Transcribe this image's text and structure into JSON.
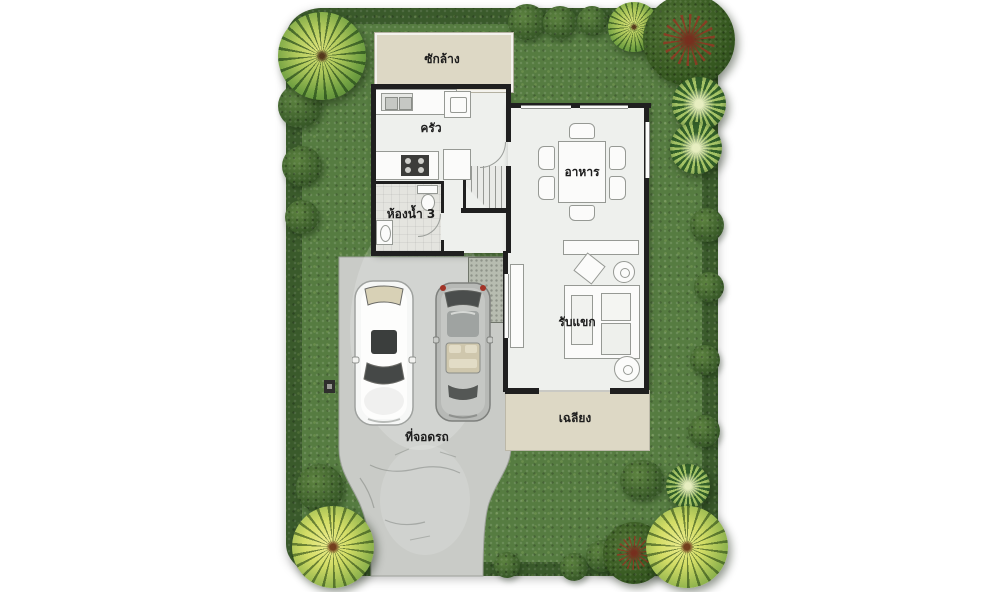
{
  "scene": {
    "type": "house floor plan with garden, driveway and two parked cars"
  },
  "rooms": {
    "laundry": {
      "label": "ซักล้าง"
    },
    "kitchen": {
      "label": "ครัว"
    },
    "bathroom3": {
      "label": "ห้องน้ำ 3"
    },
    "dining": {
      "label": "อาหาร"
    },
    "living": {
      "label": "รับแขก"
    },
    "porch": {
      "label": "เฉลียง"
    },
    "parking": {
      "label": "ที่จอดรถ"
    }
  },
  "colors": {
    "grass": "#567c41",
    "hedge": "#3a5a2b",
    "driveway": "#c9cbc7",
    "floor": "#eef0ed",
    "terrace_beige": "#ddd8c5",
    "wall": "#1f1f1f",
    "car_white": "#f6f7f6",
    "car_silver": "#b7b9b6"
  }
}
